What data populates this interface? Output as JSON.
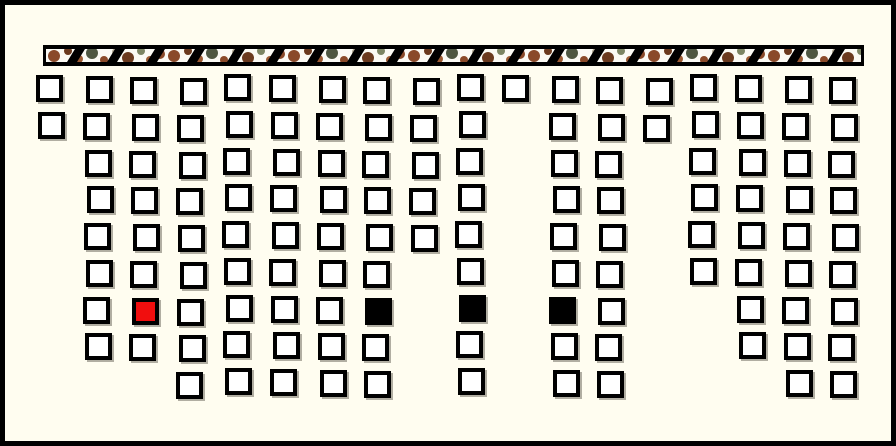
{
  "window": {
    "width": 896,
    "height": 446,
    "background_color": "#fffdf0",
    "border_color": "#000000"
  },
  "banner": {
    "x": 38,
    "y": 45,
    "width": 821,
    "height": 21,
    "frame_color": "#000000",
    "band_fill": "#fbfaf4",
    "band_inset_top": 4,
    "band_height": 13,
    "band_inset_side": 3,
    "camo_colors": [
      "#8a4a2a",
      "#6b3a1f",
      "#9c5a33",
      "#4f5741",
      "#7d8563",
      "#b3ab94"
    ],
    "blob_tile_width": 120,
    "blobs": [
      {
        "x": 8,
        "y": 7,
        "r": 6,
        "color": "#8a4a2a"
      },
      {
        "x": 22,
        "y": 2,
        "r": 4,
        "color": "#6b3a1f"
      },
      {
        "x": 33,
        "y": 10,
        "r": 4,
        "color": "#9c5a33"
      },
      {
        "x": 46,
        "y": 4,
        "r": 6,
        "color": "#4f5741"
      },
      {
        "x": 58,
        "y": 11,
        "r": 4,
        "color": "#8a4a2a"
      },
      {
        "x": 70,
        "y": 3,
        "r": 4,
        "color": "#b3ab94"
      },
      {
        "x": 82,
        "y": 9,
        "r": 6,
        "color": "#6b3a1f"
      },
      {
        "x": 95,
        "y": 2,
        "r": 4,
        "color": "#7d8563"
      },
      {
        "x": 104,
        "y": 11,
        "r": 4,
        "color": "#9c5a33"
      },
      {
        "x": 114,
        "y": 5,
        "r": 5,
        "color": "#8a4a2a"
      }
    ],
    "slashes": {
      "offset": 24,
      "spacing": 40,
      "width": 10,
      "top_shift": 8,
      "color": "#000000"
    }
  },
  "board": {
    "cell_outer_size": 27,
    "cell_border_color": "#000000",
    "cell_fill_color": "#ffffff",
    "cell_shadow_color": "#7d7a6e",
    "col_x": [
      38,
      84.6,
      131.2,
      177.8,
      224.4,
      271,
      317.6,
      364.2,
      410.8,
      457.4,
      504,
      550.6,
      597.2,
      643.8,
      690.4,
      737,
      783.6,
      830.2
    ],
    "row_y": [
      76,
      112.8,
      149.5,
      186.3,
      223,
      259.8,
      296.5,
      333.3,
      370
    ],
    "rows": [
      {
        "row": 1,
        "cols": [
          1,
          2,
          3,
          4,
          5,
          6,
          7,
          8,
          9,
          10,
          11,
          12,
          13,
          14,
          15,
          16,
          17,
          18
        ]
      },
      {
        "row": 2,
        "cols": [
          1,
          2,
          3,
          4,
          5,
          6,
          7,
          8,
          9,
          10,
          12,
          13,
          14,
          15,
          16,
          17,
          18
        ]
      },
      {
        "row": 3,
        "cols": [
          2,
          3,
          4,
          5,
          6,
          7,
          8,
          9,
          10,
          12,
          13,
          15,
          16,
          17,
          18
        ]
      },
      {
        "row": 4,
        "cols": [
          2,
          3,
          4,
          5,
          6,
          7,
          8,
          9,
          10,
          12,
          13,
          15,
          16,
          17,
          18
        ]
      },
      {
        "row": 5,
        "cols": [
          2,
          3,
          4,
          5,
          6,
          7,
          8,
          9,
          10,
          12,
          13,
          15,
          16,
          17,
          18
        ]
      },
      {
        "row": 6,
        "cols": [
          2,
          3,
          4,
          5,
          6,
          7,
          8,
          10,
          12,
          13,
          15,
          16,
          17,
          18
        ]
      },
      {
        "row": 7,
        "cols": [
          2,
          3,
          4,
          5,
          6,
          7,
          8,
          10,
          12,
          13,
          16,
          17,
          18
        ]
      },
      {
        "row": 8,
        "cols": [
          2,
          3,
          4,
          5,
          6,
          7,
          8,
          10,
          12,
          13,
          16,
          17,
          18
        ]
      },
      {
        "row": 9,
        "cols": [
          4,
          5,
          6,
          7,
          8,
          10,
          12,
          13,
          17,
          18
        ]
      }
    ],
    "filled_cells": [
      {
        "row": 7,
        "col": 3,
        "color": "#f10e0e",
        "name": "red-piece"
      },
      {
        "row": 7,
        "col": 8,
        "color": "#000000",
        "name": "black-piece"
      },
      {
        "row": 7,
        "col": 10,
        "color": "#000000",
        "name": "black-piece"
      },
      {
        "row": 7,
        "col": 12,
        "color": "#000000",
        "name": "black-piece"
      }
    ]
  }
}
